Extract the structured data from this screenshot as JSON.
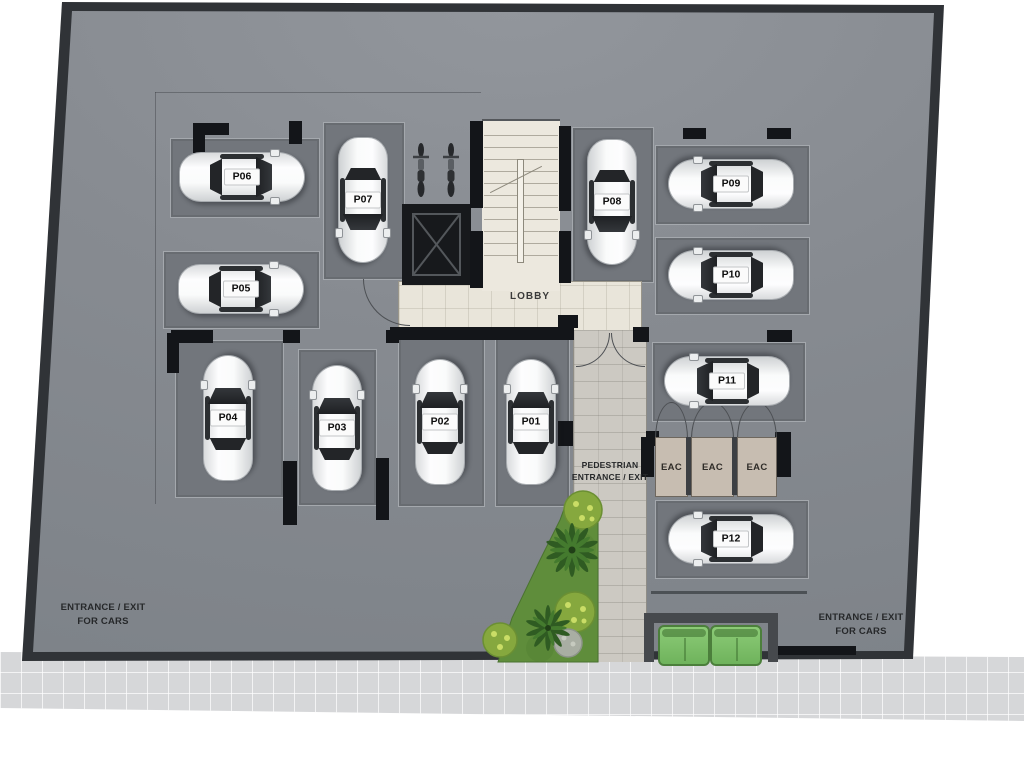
{
  "plan": {
    "stalls": [
      {
        "id": "P01",
        "label": "P01"
      },
      {
        "id": "P02",
        "label": "P02"
      },
      {
        "id": "P03",
        "label": "P03"
      },
      {
        "id": "P04",
        "label": "P04"
      },
      {
        "id": "P05",
        "label": "P05"
      },
      {
        "id": "P06",
        "label": "P06"
      },
      {
        "id": "P07",
        "label": "P07"
      },
      {
        "id": "P08",
        "label": "P08"
      },
      {
        "id": "P09",
        "label": "P09"
      },
      {
        "id": "P10",
        "label": "P10"
      },
      {
        "id": "P11",
        "label": "P11"
      },
      {
        "id": "P12",
        "label": "P12"
      }
    ],
    "lobby_label": "LOBBY",
    "pedestrian_entrance": {
      "line1": "PEDESTRIAN",
      "line2": "ENTRANCE / EXIT"
    },
    "car_entrance_left": {
      "line1": "ENTRANCE / EXIT",
      "line2": "FOR CARS"
    },
    "car_entrance_right": {
      "line1": "ENTRANCE / EXIT",
      "line2": "FOR CARS"
    },
    "eac_closets": [
      {
        "label": "EAC"
      },
      {
        "label": "EAC"
      },
      {
        "label": "EAC"
      }
    ],
    "colors": {
      "site_gray": "#878b91",
      "stall_gray": "#72767c",
      "wall_dark": "#303337",
      "floor_beige": "#e9e5da",
      "walkway": "#ccc9c2",
      "sidewalk": "#d6d7d9",
      "grass_green": "#5f8d3b",
      "bench_green": "#7dc069",
      "eac_tan": "#c7bdb1",
      "car_white": "#f4f5f6"
    }
  }
}
